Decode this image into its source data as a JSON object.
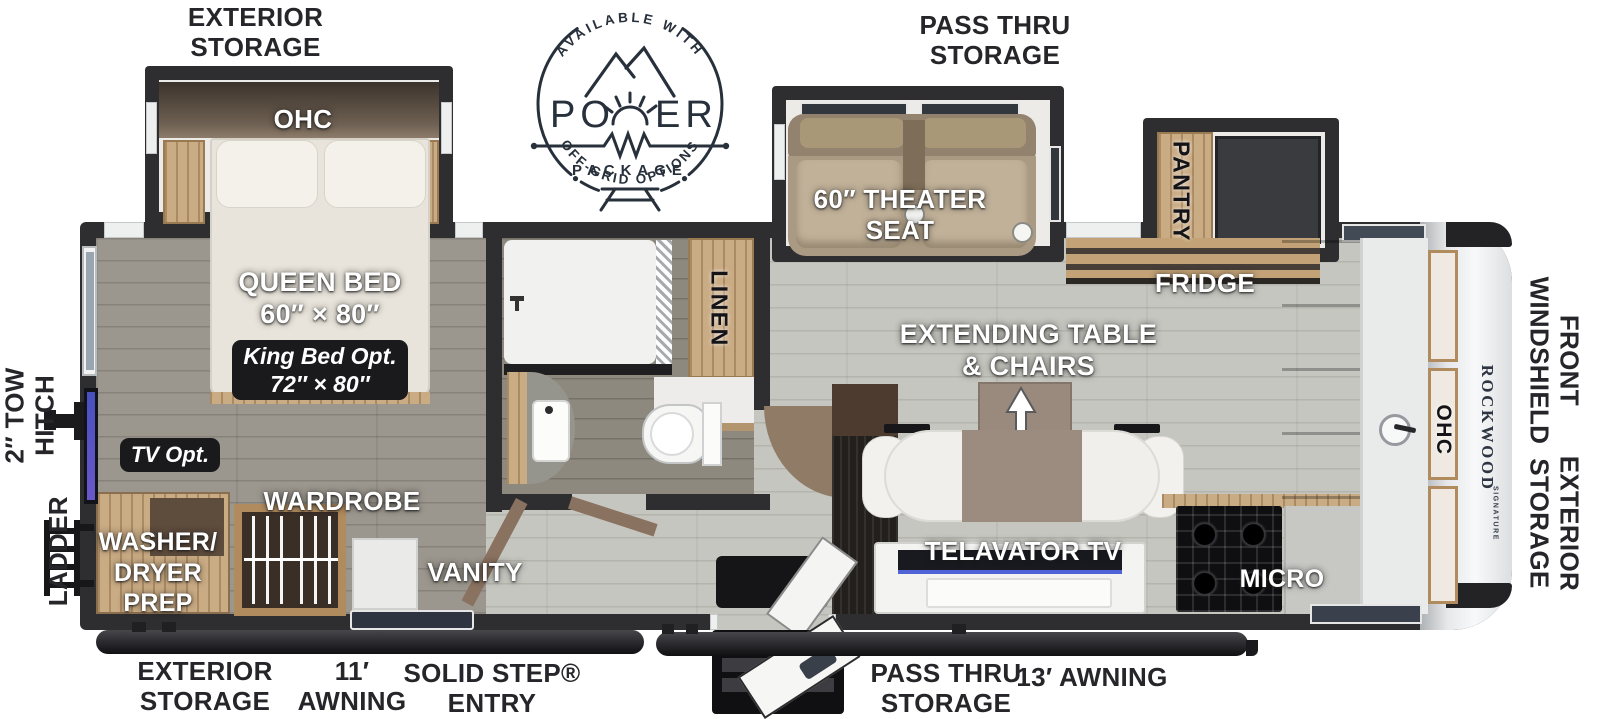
{
  "labels": {
    "ext_storage_top": "EXTERIOR\nSTORAGE",
    "pass_thru_top": "PASS THRU\nSTORAGE",
    "ohc_bed": "OHC",
    "theater": "60″ THEATER\nSEAT",
    "pantry": "PANTRY",
    "fridge": "FRIDGE",
    "queen": "QUEEN BED\n60″ × 80″",
    "king_opt": "King Bed Opt.\n72″ × 80″",
    "tv_opt": "TV Opt.",
    "linen": "LINEN",
    "ext_table": "EXTENDING TABLE\n& CHAIRS",
    "wardrobe": "WARDROBE",
    "vanity": "VANITY",
    "washer": "WASHER/\nDRYER\nPREP",
    "telavator": "TELAVATOR TV",
    "micro": "MICRO",
    "ohc_front": "OHC",
    "rockwood": "ROCKWOOD",
    "signature": "SIGNATURE",
    "tow_hitch": "2″ TOW\nHITCH",
    "ladder": "LADDER",
    "front_windshield": "FRONT\nWINDSHIELD",
    "ext_storage_right": "EXTERIOR\nSTORAGE",
    "ext_storage_bottom": "EXTERIOR\nSTORAGE",
    "awning_11": "11′\nAWNING",
    "solid_step": "SOLID STEP®\nENTRY",
    "pass_thru_bottom": "PASS THRU\nSTORAGE",
    "awning_13": "13′ AWNING"
  },
  "badge": {
    "available": "AVAILABLE WITH",
    "po": "PO",
    "er": "ER",
    "package": "PACKAGE",
    "offgrid": "OFF-GRID OPTIONS"
  },
  "colors": {
    "wall": "#2e2e31",
    "wood": "#c9ab84",
    "floor_living": "#c6c6c0",
    "floor_bedroom": "#9c978e",
    "logo_ink": "#27303b"
  }
}
